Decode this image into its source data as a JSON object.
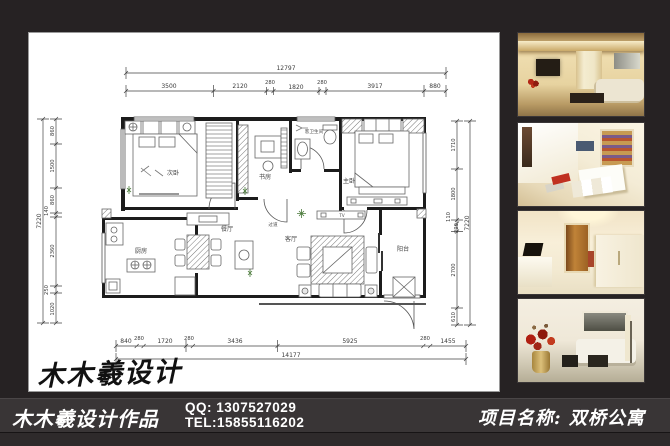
{
  "colors": {
    "background": "#262223",
    "footer_band": "#393536",
    "sheet": "#ffffff",
    "plan_line": "#1c1c1c",
    "accent_red": "#b22616"
  },
  "signature": "木木羲设计",
  "footer": {
    "studio": "木木羲设计作品",
    "qq": "QQ: 1307527029",
    "tel": "TEL:15855116202",
    "project": "项目名称: 双桥公寓"
  },
  "photos": [
    {
      "name": "living-room-tv-wall"
    },
    {
      "name": "dining-area-overhead"
    },
    {
      "name": "entry-hallway"
    },
    {
      "name": "living-room-sofa-flowers"
    }
  ],
  "plan": {
    "rooms": {
      "bed2": "次卧",
      "study": "书房",
      "bath": "客卫生间",
      "master": "主卧",
      "kitchen": "厨房",
      "dining": "餐厅",
      "hall": "过道",
      "living": "客厅",
      "balcony": "阳台"
    },
    "tv_label": "TV",
    "dims": {
      "top_total": "12797",
      "top_segments": [
        "3500",
        "2120",
        "280",
        "1820",
        "280",
        "3917",
        "880"
      ],
      "left_total": "7220",
      "left_segments": [
        "860",
        "1500",
        "860",
        "140",
        "2360",
        "250",
        "1020"
      ],
      "right_total": "7220",
      "right_segments": [
        "1710",
        "1800",
        "110",
        "290",
        "2700",
        "610"
      ],
      "bottom_total": "14177",
      "bottom_segments": [
        "840",
        "280",
        "1720",
        "280",
        "3436",
        "5925",
        "280",
        "1455"
      ]
    }
  }
}
